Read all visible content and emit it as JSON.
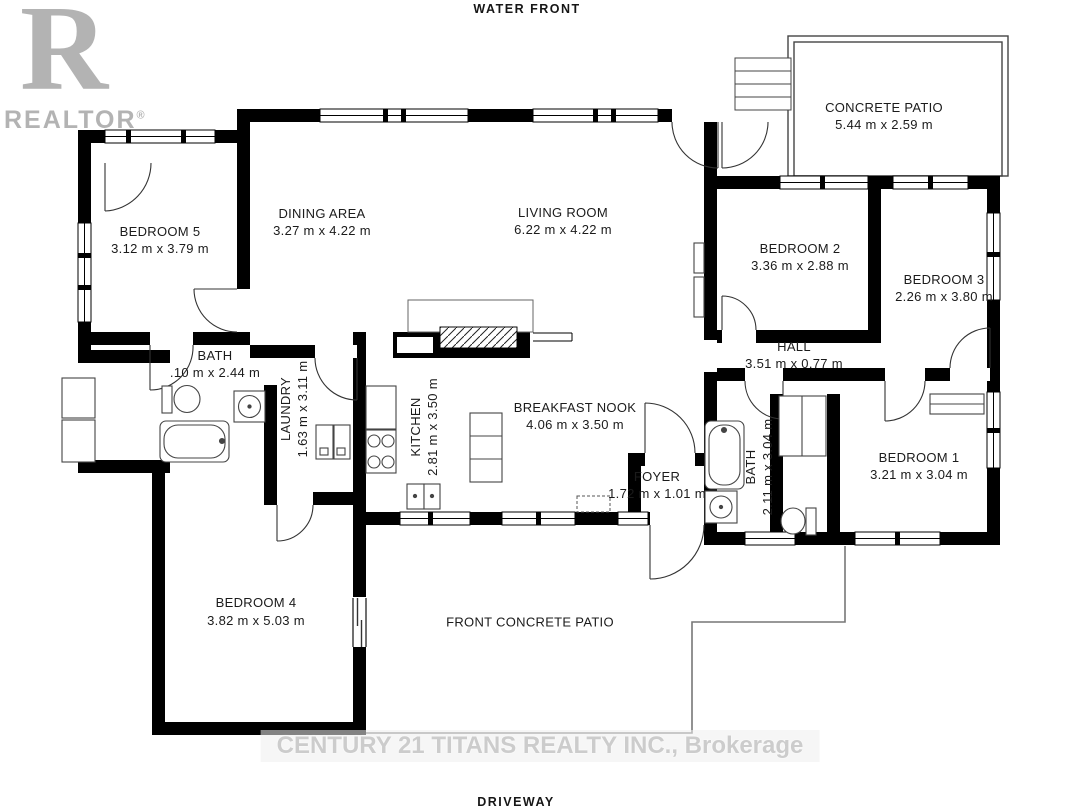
{
  "site_labels": {
    "top": "WATER  FRONT",
    "bottom": "DRIVEWAY"
  },
  "watermarks": {
    "realtor_logo_letter": "R",
    "realtor_text": "REALTOR",
    "registered_mark": "®",
    "brokerage_line": "CENTURY 21 TITANS REALTY INC., Brokerage"
  },
  "colors": {
    "walls": "#000000",
    "background": "#ffffff",
    "watermark_gray": "#b3b3b3",
    "brokerage_gray": "#cccccc"
  },
  "rooms": [
    {
      "id": "bedroom5",
      "name": "BEDROOM 5",
      "dims": "3.12 m x 3.79 m"
    },
    {
      "id": "dining-area",
      "name": "DINING AREA",
      "dims": "3.27 m x 4.22 m"
    },
    {
      "id": "living-room",
      "name": "LIVING ROOM",
      "dims": "6.22 m x 4.22 m"
    },
    {
      "id": "concrete-patio",
      "name": "CONCRETE PATIO",
      "dims": "5.44 m x 2.59 m"
    },
    {
      "id": "bedroom2",
      "name": "BEDROOM 2",
      "dims": "3.36 m x 2.88 m"
    },
    {
      "id": "bedroom3",
      "name": "BEDROOM 3",
      "dims": "2.26 m x 3.80 m"
    },
    {
      "id": "hall",
      "name": "HALL",
      "dims": "3.51 m x 0.77 m"
    },
    {
      "id": "bath-main",
      "name": "BATH",
      "dims": ".10 m x 2.44 m"
    },
    {
      "id": "laundry",
      "name": "LAUNDRY",
      "dims": "1.63 m x 3.11 m"
    },
    {
      "id": "kitchen",
      "name": "KITCHEN",
      "dims": "2.81 m x 3.50 m"
    },
    {
      "id": "breakfast-nook",
      "name": "BREAKFAST NOOK",
      "dims": "4.06 m x 3.50 m"
    },
    {
      "id": "foyer",
      "name": "FOYER",
      "dims": "1.72 m x 1.01 m"
    },
    {
      "id": "bath-ensuite",
      "name": "BATH",
      "dims": "2.11 m x 3.04 m"
    },
    {
      "id": "bedroom1",
      "name": "BEDROOM 1",
      "dims": "3.21 m x 3.04 m"
    },
    {
      "id": "bedroom4",
      "name": "BEDROOM 4",
      "dims": "3.82 m x 5.03 m"
    },
    {
      "id": "front-patio",
      "name": "FRONT CONCRETE PATIO",
      "dims": ""
    }
  ]
}
